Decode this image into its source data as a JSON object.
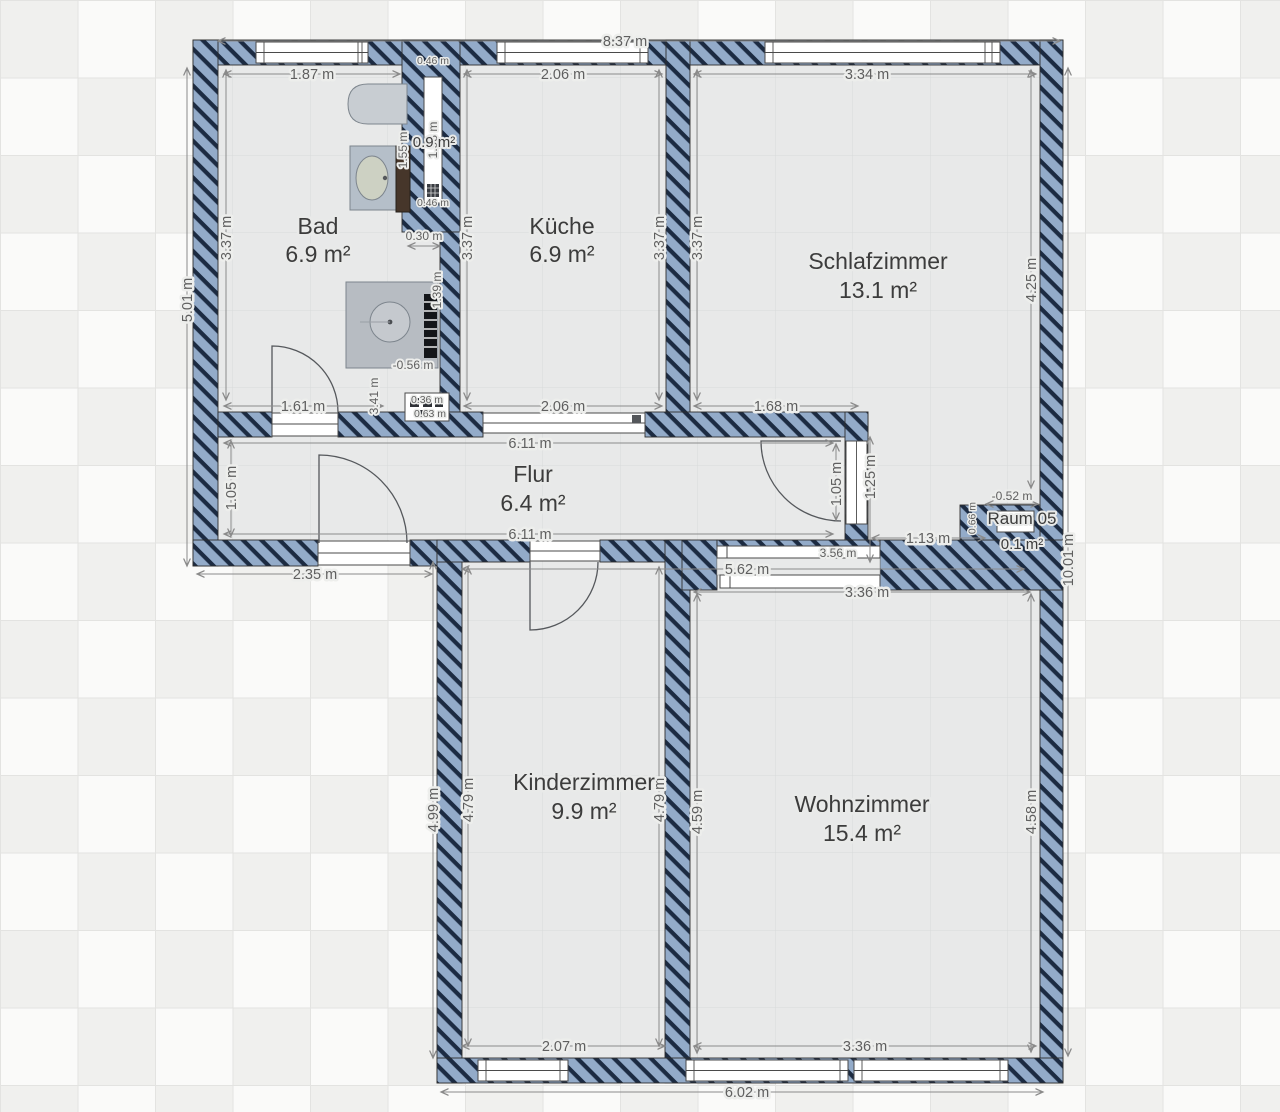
{
  "plan": {
    "rooms": {
      "bad": {
        "name": "Bad",
        "area": "6.9 m²"
      },
      "kueche": {
        "name": "Küche",
        "area": "6.9 m²"
      },
      "schlafzimmer": {
        "name": "Schlafzimmer",
        "area": "13.1 m²"
      },
      "flur": {
        "name": "Flur",
        "area": "6.4 m²"
      },
      "kinderzimmer": {
        "name": "Kinderzimmer",
        "area": "9.9 m²"
      },
      "wohnzimmer": {
        "name": "Wohnzimmer",
        "area": "15.4 m²"
      },
      "raum05": {
        "name": "Raum 05",
        "area": "0.1 m²"
      },
      "schacht": {
        "name": "",
        "area": "0.9 m²"
      }
    },
    "dims": {
      "overall_top": "8.37 m",
      "overall_right": "10.01 m",
      "overall_bottom": "6.02 m",
      "outer_left": "5.01 m",
      "entry_left": "2.35 m",
      "bad_top": "1.87 m",
      "bad_left": "3.37 m",
      "bad_bottom": "1.61 m",
      "bad_niche": "3.41 m",
      "bad_fixture": "1.55 m",
      "shower_width": "-0.56 m",
      "niche_offset": "0.30 m",
      "niche_height": "1.39 m",
      "niche_a": "0.36 m",
      "niche_b": "0.63 m",
      "shaft_height": "1.98 m",
      "shaft_top": "0.46 m",
      "shaft_bottom": "0.46 m",
      "kueche_top": "2.06 m",
      "kueche_left": "3.37 m",
      "kueche_right": "3.37 m",
      "kueche_bottom": "2.06 m",
      "schlaf_top": "3.34 m",
      "schlaf_left": "3.37 m",
      "schlaf_right": "4.25 m",
      "schlaf_bottom": "1.68 m",
      "flur_top": "6.11 m",
      "flur_bottom": "6.11 m",
      "flur_left": "1.05 m",
      "flur_right": "1.05 m",
      "flur_door": "1.25 m",
      "right_pass": "1.13 m",
      "raum05_top": "-0.52 m",
      "raum05_left": "0.66 m",
      "slider": "3.56 m",
      "slider_total": "5.62 m",
      "wohn_top": "3.36 m",
      "kinder_outer": "4.99 m",
      "kinder_left": "4.79 m",
      "kinder_right": "4.79 m",
      "kinder_bottom": "2.07 m",
      "wohn_left": "4.59 m",
      "wohn_right": "4.58 m",
      "wohn_bottom": "3.36 m"
    },
    "colors": {
      "wall_fill": "#93abc9",
      "wall_hatch": "#1c2b42",
      "floor": "#e8e9e9",
      "background": "#f2f2f0",
      "dim_text": "#5f5f5f",
      "room_text": "#3c3c3c"
    }
  }
}
